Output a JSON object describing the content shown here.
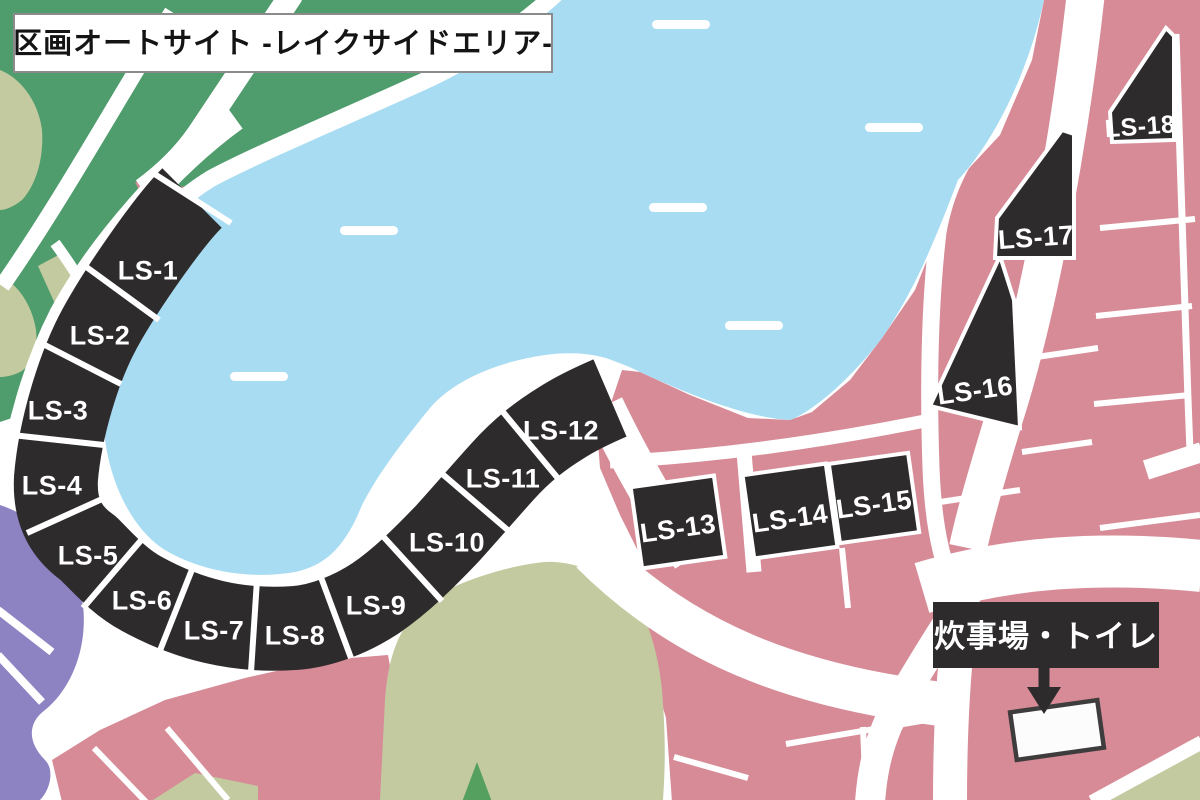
{
  "title": "区画オートサイト -レイクサイドエリア-",
  "map": {
    "sites": [
      {
        "label": "LS-1"
      },
      {
        "label": "LS-2"
      },
      {
        "label": "LS-3"
      },
      {
        "label": "LS-4"
      },
      {
        "label": "LS-5"
      },
      {
        "label": "LS-6"
      },
      {
        "label": "LS-7"
      },
      {
        "label": "LS-8"
      },
      {
        "label": "LS-9"
      },
      {
        "label": "LS-10"
      },
      {
        "label": "LS-11"
      },
      {
        "label": "LS-12"
      },
      {
        "label": "LS-13"
      },
      {
        "label": "LS-14"
      },
      {
        "label": "LS-15"
      },
      {
        "label": "LS-16"
      },
      {
        "label": "LS-17"
      },
      {
        "label": "LS-18"
      }
    ],
    "facility": {
      "label": "炊事場・トイレ"
    },
    "colors": {
      "lake": "#a8dcf2",
      "site_dark": "#2e2b2c",
      "plot_pink": "#d78b97",
      "forest_green": "#4f9c6d",
      "sage": "#c3caa0",
      "purple": "#8d83c3",
      "road_white": "#ffffff",
      "tree_green": "#55a05f"
    }
  }
}
